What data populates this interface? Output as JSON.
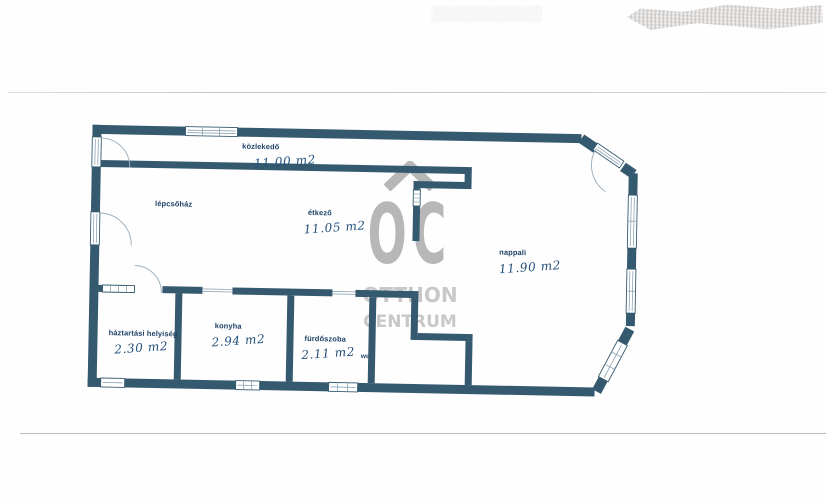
{
  "watermark": {
    "monogram": "OC",
    "line1": "OTTHON",
    "line2": "CENTRUM"
  },
  "rooms": [
    {
      "name": "közlekedő",
      "area": "11.00 m2"
    },
    {
      "name": "lépcsőház",
      "area": ""
    },
    {
      "name": "étkező",
      "area": "11.05 m2"
    },
    {
      "name": "nappali",
      "area": "11.90 m2"
    },
    {
      "name": "háztartási helyiség",
      "area": "2.30 m2"
    },
    {
      "name": "konyha",
      "area": "2.94 m2"
    },
    {
      "name": "fürdőszoba",
      "area": "2.11 m2",
      "extra": "wc"
    }
  ],
  "colors": {
    "wall": "#355a70",
    "print_label": "#1d4165",
    "handwriting": "#24507a",
    "watermark_gray": "#b4b4b4"
  }
}
